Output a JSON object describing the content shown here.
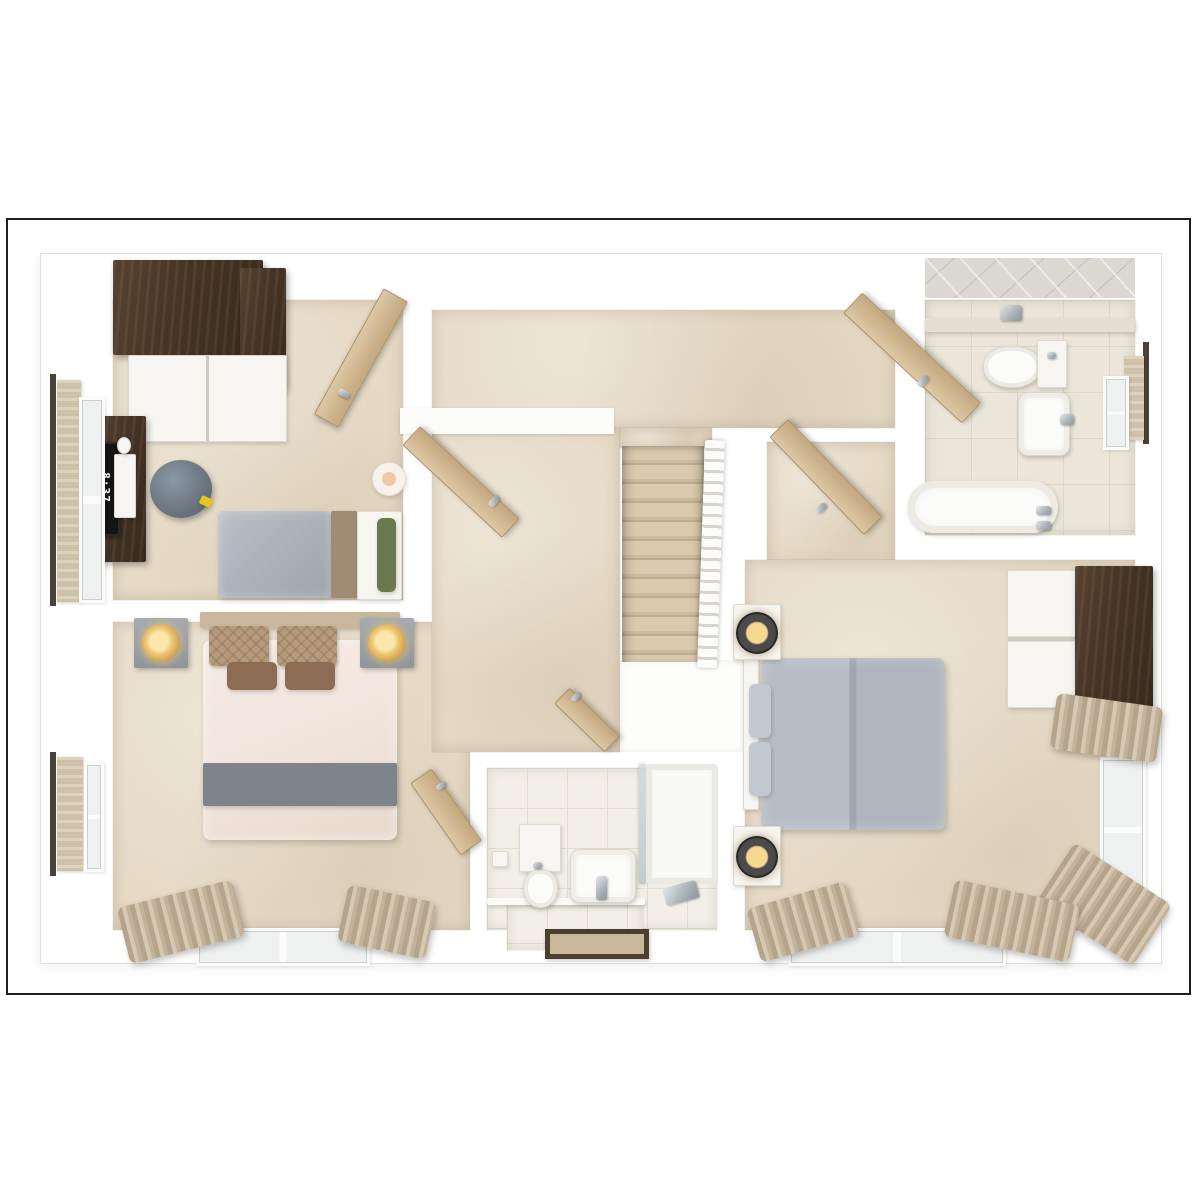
{
  "monitor": {
    "clock": "8:37"
  },
  "palette": {
    "page_background": "#ffffff",
    "frame_border": "#1e1e1e",
    "wall_white": "#fcfcfb",
    "carpet": "#e6dac6",
    "bathroom_tile": "#ebe6d9",
    "ensuite_tile": "#f1efe7",
    "wood_dark": "#453424",
    "wood_cabinet_gray": "#635e56",
    "wood_door_light": "#d0b68f",
    "duvet_gray": "#aab0b8",
    "duvet_cream": "#f3e8e1",
    "runner_gray": "#7f838a",
    "pillow_green": "#6c7950",
    "pillow_tan": "#b79b7c",
    "cushion_brown": "#8c6d53",
    "curtain": "#c3b29a",
    "lamp_gold": "#edc674",
    "chrome": "#a9b1b6",
    "blind_rod": "#4a4138"
  },
  "elements": [
    {
      "n": "plan-footprint",
      "x": 40,
      "y": 253,
      "w": 1120,
      "h": 709,
      "c": "footprint"
    },
    {
      "n": "bedroom3-floor",
      "x": 113,
      "y": 300,
      "w": 290,
      "h": 300,
      "c": "carpet"
    },
    {
      "n": "bedroom2-floor",
      "x": 113,
      "y": 622,
      "w": 357,
      "h": 308,
      "c": "carpet"
    },
    {
      "n": "landing-top-floor",
      "x": 432,
      "y": 310,
      "w": 463,
      "h": 118,
      "c": "carpet"
    },
    {
      "n": "landing-left-floor",
      "x": 432,
      "y": 428,
      "w": 188,
      "h": 324,
      "c": "carpet"
    },
    {
      "n": "stairs-top-strip",
      "x": 620,
      "y": 428,
      "w": 92,
      "h": 20,
      "c": "carpet"
    },
    {
      "n": "bedroom1-entry-floor",
      "x": 767,
      "y": 442,
      "w": 128,
      "h": 122,
      "c": "carpet"
    },
    {
      "n": "bedroom1-floor",
      "x": 745,
      "y": 560,
      "w": 390,
      "h": 370,
      "c": "carpet"
    },
    {
      "n": "bathroom-floor",
      "x": 925,
      "y": 300,
      "w": 210,
      "h": 235,
      "c": "tile"
    },
    {
      "n": "ensuite-floor",
      "x": 487,
      "y": 768,
      "w": 230,
      "h": 162,
      "c": "tile2"
    },
    {
      "n": "ensuite-entry-floor",
      "x": 507,
      "y": 903,
      "w": 136,
      "h": 47,
      "c": "tile2"
    },
    {
      "n": "bathroom-ceiling-tiles",
      "x": 925,
      "y": 258,
      "w": 210,
      "h": 40,
      "c": "ceiltile"
    },
    {
      "n": "stairwell-void",
      "x": 620,
      "y": 660,
      "w": 125,
      "h": 92,
      "c": "voidbox"
    },
    {
      "n": "wall-alcove",
      "x": 400,
      "y": 408,
      "w": 214,
      "h": 26,
      "c": "wallseg"
    },
    {
      "n": "staircase",
      "x": 622,
      "y": 446,
      "w": 82,
      "h": 216,
      "c": "stairs"
    },
    {
      "n": "stair-banister",
      "x": 701,
      "y": 440,
      "w": 20,
      "h": 228,
      "c": "banister",
      "r": 2
    },
    {
      "n": "bathroom-wall-ledge",
      "x": 925,
      "y": 318,
      "w": 210,
      "h": 14,
      "c": "soft",
      "f": "#e4dfd2"
    },
    {
      "n": "wardrobe3-top",
      "x": 113,
      "y": 260,
      "w": 150,
      "h": 95,
      "c": "wood-dark"
    },
    {
      "n": "wardrobe3-side",
      "x": 240,
      "y": 268,
      "w": 46,
      "h": 122,
      "c": "wood-dark"
    },
    {
      "n": "wardrobe3-front",
      "x": 128,
      "y": 355,
      "w": 157,
      "h": 85,
      "c": "white-furn doors2"
    },
    {
      "n": "desk3",
      "x": 88,
      "y": 416,
      "w": 58,
      "h": 146,
      "c": "wood-dark"
    },
    {
      "n": "monitor3-screen",
      "x": 94,
      "y": 442,
      "w": 22,
      "h": 90,
      "c": "screen"
    },
    {
      "n": "keyboard3",
      "x": 114,
      "y": 454,
      "w": 20,
      "h": 62,
      "c": "white-furn"
    },
    {
      "n": "mouse3",
      "x": 117,
      "y": 437,
      "w": 12,
      "h": 15,
      "c": "white-furn round"
    },
    {
      "n": "stool3",
      "x": 150,
      "y": 460,
      "w": 62,
      "h": 58,
      "c": "stool"
    },
    {
      "n": "stool3-tag",
      "x": 200,
      "y": 497,
      "w": 12,
      "h": 9,
      "c": "soft",
      "f": "#e7c41c",
      "r": 25
    },
    {
      "n": "bed3-duvet",
      "x": 218,
      "y": 511,
      "w": 113,
      "h": 87,
      "c": "duvet-gray"
    },
    {
      "n": "bed3-blanket-band",
      "x": 331,
      "y": 511,
      "w": 26,
      "h": 87,
      "c": "soft",
      "f": "#a18b74"
    },
    {
      "n": "bed3-mattress",
      "x": 357,
      "y": 511,
      "w": 43,
      "h": 87,
      "c": "white-furn"
    },
    {
      "n": "bed3-pillow-green",
      "x": 377,
      "y": 518,
      "w": 19,
      "h": 74,
      "c": "soft rad6",
      "f": "#6c7950"
    },
    {
      "n": "lamp-bedroom3",
      "x": 372,
      "y": 462,
      "w": 32,
      "h": 32,
      "c": "lamp-white"
    },
    {
      "n": "window3-rod",
      "x": 50,
      "y": 374,
      "w": 6,
      "h": 232,
      "f": "#4a4138"
    },
    {
      "n": "window3-blind",
      "x": 57,
      "y": 380,
      "w": 24,
      "h": 222,
      "c": "blind"
    },
    {
      "n": "window3-frame",
      "x": 79,
      "y": 397,
      "w": 20,
      "h": 200,
      "c": "winframe"
    },
    {
      "n": "bed2-headboard",
      "x": 200,
      "y": 612,
      "w": 200,
      "h": 16,
      "c": "soft",
      "f": "#c9b69d"
    },
    {
      "n": "bed2-duvet",
      "x": 203,
      "y": 640,
      "w": 194,
      "h": 200,
      "c": "duvet-cream"
    },
    {
      "n": "bed2-pillow-left",
      "x": 209,
      "y": 626,
      "w": 60,
      "h": 40,
      "c": "pillow-tan"
    },
    {
      "n": "bed2-pillow-right",
      "x": 277,
      "y": 626,
      "w": 60,
      "h": 40,
      "c": "pillow-tan"
    },
    {
      "n": "bed2-cushion-left",
      "x": 227,
      "y": 662,
      "w": 50,
      "h": 28,
      "c": "soft rad6",
      "f": "#8c6d53"
    },
    {
      "n": "bed2-cushion-right",
      "x": 285,
      "y": 662,
      "w": 50,
      "h": 28,
      "c": "soft rad6",
      "f": "#8c6d53"
    },
    {
      "n": "bed2-runner",
      "x": 203,
      "y": 763,
      "w": 194,
      "h": 43,
      "c": "soft",
      "f": "#7f838a"
    },
    {
      "n": "nightstand2-left",
      "x": 134,
      "y": 618,
      "w": 54,
      "h": 50,
      "c": "nightstand"
    },
    {
      "n": "nightstand2-right",
      "x": 360,
      "y": 618,
      "w": 54,
      "h": 50,
      "c": "nightstand"
    },
    {
      "n": "lamp2-left",
      "x": 142,
      "y": 624,
      "w": 38,
      "h": 38,
      "c": "lamp-gold"
    },
    {
      "n": "lamp2-right",
      "x": 368,
      "y": 624,
      "w": 38,
      "h": 38,
      "c": "lamp-gold"
    },
    {
      "n": "window2-bottom",
      "x": 196,
      "y": 928,
      "w": 168,
      "h": 32,
      "c": "winframe-h"
    },
    {
      "n": "curtain2-left",
      "x": 122,
      "y": 893,
      "w": 118,
      "h": 58,
      "c": "curtain",
      "r": -14
    },
    {
      "n": "curtain2-right",
      "x": 342,
      "y": 893,
      "w": 90,
      "h": 58,
      "c": "curtain",
      "r": 12
    },
    {
      "n": "blind2-rod",
      "x": 50,
      "y": 752,
      "w": 6,
      "h": 124,
      "f": "#4a4138"
    },
    {
      "n": "blind2-panel",
      "x": 57,
      "y": 757,
      "w": 26,
      "h": 114,
      "c": "blind"
    },
    {
      "n": "blind2-frame",
      "x": 84,
      "y": 762,
      "w": 14,
      "h": 104,
      "c": "winframe"
    },
    {
      "n": "bed1-headboard",
      "x": 743,
      "y": 656,
      "w": 14,
      "h": 152,
      "c": "white-furn"
    },
    {
      "n": "bed1-duvet",
      "x": 761,
      "y": 658,
      "w": 184,
      "h": 172,
      "c": "duvet-gray2"
    },
    {
      "n": "bed1-pillow-top",
      "x": 749,
      "y": 684,
      "w": 22,
      "h": 54,
      "c": "soft rad6",
      "f": "#c3c8ce"
    },
    {
      "n": "bed1-pillow-bottom",
      "x": 749,
      "y": 742,
      "w": 22,
      "h": 54,
      "c": "soft rad6",
      "f": "#c3c8ce"
    },
    {
      "n": "nightstand1-top",
      "x": 733,
      "y": 604,
      "w": 46,
      "h": 54,
      "c": "white-furn"
    },
    {
      "n": "nightstand1-bottom",
      "x": 733,
      "y": 826,
      "w": 46,
      "h": 58,
      "c": "white-furn"
    },
    {
      "n": "lamp1-top",
      "x": 736,
      "y": 612,
      "w": 42,
      "h": 42,
      "c": "lamp-black"
    },
    {
      "n": "lamp1-bottom",
      "x": 736,
      "y": 836,
      "w": 42,
      "h": 42,
      "c": "lamp-black"
    },
    {
      "n": "wardrobe1-doors",
      "x": 1007,
      "y": 570,
      "w": 68,
      "h": 136,
      "c": "white-furn doorsH"
    },
    {
      "n": "wardrobe1-body",
      "x": 1075,
      "y": 566,
      "w": 78,
      "h": 142,
      "c": "wood-dark"
    },
    {
      "n": "window1-right",
      "x": 1100,
      "y": 757,
      "w": 40,
      "h": 140,
      "c": "winframe"
    },
    {
      "n": "curtain1-right-top",
      "x": 1053,
      "y": 700,
      "w": 107,
      "h": 56,
      "c": "curtain",
      "r": 8
    },
    {
      "n": "curtain1-right-bottom",
      "x": 1046,
      "y": 868,
      "w": 116,
      "h": 72,
      "c": "curtain",
      "r": 33
    },
    {
      "n": "window1-bottom",
      "x": 788,
      "y": 928,
      "w": 212,
      "h": 32,
      "c": "winframe-h"
    },
    {
      "n": "curtain1-bottom-left",
      "x": 752,
      "y": 894,
      "w": 102,
      "h": 56,
      "c": "curtain",
      "r": -16
    },
    {
      "n": "curtain1-bottom-right",
      "x": 948,
      "y": 892,
      "w": 128,
      "h": 58,
      "c": "curtain",
      "r": 12
    },
    {
      "n": "toilet1-bowl",
      "x": 983,
      "y": 346,
      "w": 56,
      "h": 40,
      "c": "toilet"
    },
    {
      "n": "toilet1-cistern",
      "x": 1037,
      "y": 340,
      "w": 28,
      "h": 46,
      "c": "white-furn"
    },
    {
      "n": "toilet1-flush",
      "x": 1047,
      "y": 352,
      "w": 9,
      "h": 7,
      "c": "chrome"
    },
    {
      "n": "tp-holder1",
      "x": 1000,
      "y": 305,
      "w": 22,
      "h": 16,
      "c": "chrome"
    },
    {
      "n": "sink1",
      "x": 1018,
      "y": 392,
      "w": 50,
      "h": 62,
      "c": "sink"
    },
    {
      "n": "sink1-tap",
      "x": 1060,
      "y": 414,
      "w": 14,
      "h": 11,
      "c": "chrome"
    },
    {
      "n": "bathtub",
      "x": 908,
      "y": 481,
      "w": 150,
      "h": 52,
      "c": "tub"
    },
    {
      "n": "tub-tap-a",
      "x": 1036,
      "y": 506,
      "w": 15,
      "h": 9,
      "c": "chrome"
    },
    {
      "n": "tub-tap-b",
      "x": 1036,
      "y": 521,
      "w": 15,
      "h": 9,
      "c": "chrome"
    },
    {
      "n": "window-bath-rod",
      "x": 1143,
      "y": 342,
      "w": 6,
      "h": 102,
      "f": "#4a4138"
    },
    {
      "n": "window-bath-blind",
      "x": 1124,
      "y": 356,
      "w": 20,
      "h": 84,
      "c": "blind"
    },
    {
      "n": "window-bath-frame",
      "x": 1103,
      "y": 376,
      "w": 20,
      "h": 68,
      "c": "winframe"
    },
    {
      "n": "ensuite-step-edge",
      "x": 487,
      "y": 898,
      "w": 158,
      "h": 7,
      "c": "soft",
      "f": "#fafaf8"
    },
    {
      "n": "toilet2-cistern",
      "x": 519,
      "y": 824,
      "w": 40,
      "h": 46,
      "c": "white-furn"
    },
    {
      "n": "toilet2-bowl",
      "x": 523,
      "y": 869,
      "w": 33,
      "h": 37,
      "c": "toilet"
    },
    {
      "n": "toilet2-flush",
      "x": 533,
      "y": 862,
      "w": 9,
      "h": 7,
      "c": "chrome"
    },
    {
      "n": "tp-holder2",
      "x": 492,
      "y": 851,
      "w": 14,
      "h": 14,
      "c": "white-furn"
    },
    {
      "n": "sink2",
      "x": 570,
      "y": 849,
      "w": 64,
      "h": 52,
      "c": "sink"
    },
    {
      "n": "sink2-tap",
      "x": 596,
      "y": 876,
      "w": 11,
      "h": 24,
      "c": "chrome"
    },
    {
      "n": "shower-glass",
      "x": 639,
      "y": 764,
      "w": 7,
      "h": 120,
      "c": "glass"
    },
    {
      "n": "shower-tray",
      "x": 646,
      "y": 764,
      "w": 72,
      "h": 120,
      "c": "tray"
    },
    {
      "n": "shower-handset",
      "x": 664,
      "y": 884,
      "w": 34,
      "h": 18,
      "c": "chrome",
      "r": -15
    },
    {
      "n": "bath-mat",
      "x": 545,
      "y": 929,
      "w": 94,
      "h": 20,
      "c": "mat"
    },
    {
      "n": "door-bedroom3",
      "x": 347,
      "y": 286,
      "w": 26,
      "h": 142,
      "c": "door-wood",
      "r": 29
    },
    {
      "n": "door-bedroom3-handle",
      "x": 338,
      "y": 390,
      "w": 12,
      "h": 7,
      "c": "chrome",
      "r": 29
    },
    {
      "n": "door-corridor",
      "x": 448,
      "y": 414,
      "w": 24,
      "h": 134,
      "c": "door-wood",
      "r": -47
    },
    {
      "n": "door-corridor-handle",
      "x": 488,
      "y": 498,
      "w": 12,
      "h": 7,
      "c": "chrome",
      "r": -47
    },
    {
      "n": "door-bathroom",
      "x": 898,
      "y": 277,
      "w": 26,
      "h": 160,
      "c": "door-wood",
      "r": -47
    },
    {
      "n": "door-bathroom-handle",
      "x": 917,
      "y": 378,
      "w": 12,
      "h": 7,
      "c": "chrome",
      "r": -47
    },
    {
      "n": "door-bedroom1",
      "x": 813,
      "y": 409,
      "w": 24,
      "h": 134,
      "c": "door-wood",
      "r": -44
    },
    {
      "n": "door-bedroom1-handle",
      "x": 815,
      "y": 505,
      "w": 12,
      "h": 7,
      "c": "chrome",
      "r": -44
    },
    {
      "n": "door-ensuite",
      "x": 576,
      "y": 685,
      "w": 20,
      "h": 68,
      "c": "door-wood",
      "r": -46
    },
    {
      "n": "door-ensuite-handle",
      "x": 571,
      "y": 694,
      "w": 10,
      "h": 6,
      "c": "chrome",
      "r": -46
    },
    {
      "n": "door-bedroom2",
      "x": 433,
      "y": 768,
      "w": 24,
      "h": 86,
      "c": "door-wood",
      "r": -35
    },
    {
      "n": "door-bedroom2-handle",
      "x": 436,
      "y": 783,
      "w": 10,
      "h": 6,
      "c": "chrome",
      "r": -35
    }
  ]
}
